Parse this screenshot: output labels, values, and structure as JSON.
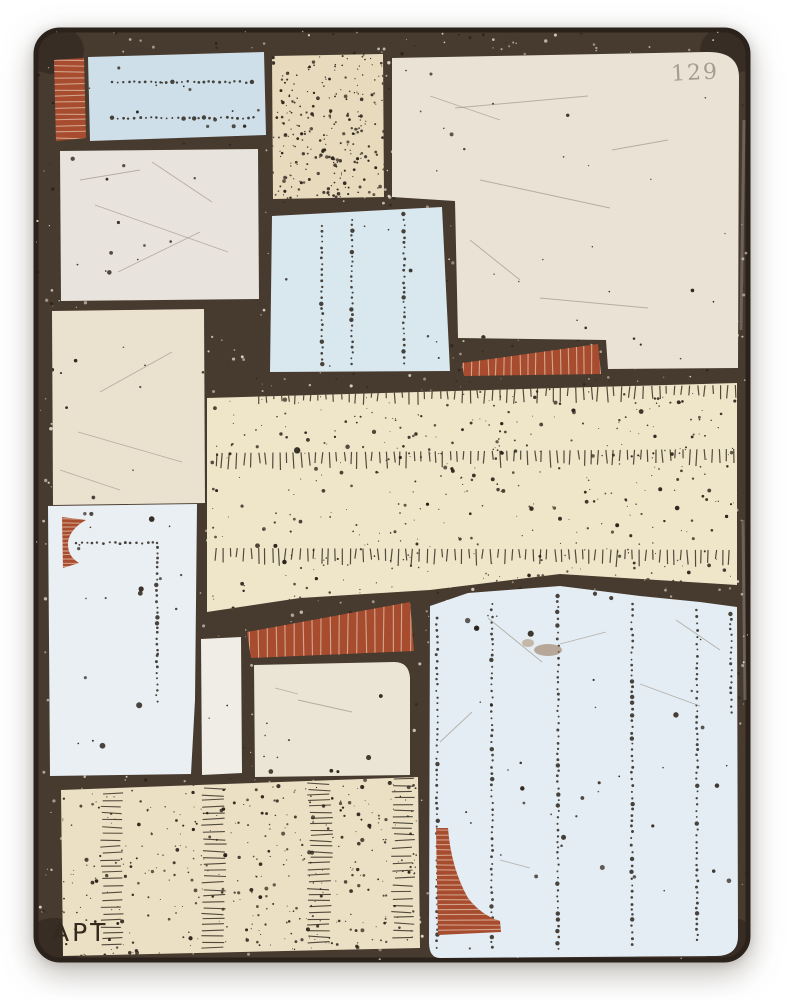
{
  "artwork": {
    "description": "Abstract mixed-media encaustic panel: patchwork of cream, tan and pale blue tiles with rust-red striped accents set in a dark speckled ground",
    "stamp": "129",
    "signature": "APT.",
    "palette": {
      "page": "#ffffff",
      "grout": "#473a2f",
      "grout_dark": "#2b221b",
      "speckle": "#e3dccd",
      "pepper": "#1f1913",
      "ink": "#2c241b",
      "red": "#a84c30",
      "red_stripe": "#ddb89f",
      "stamp_color": "#968b80",
      "sig_color": "#33291d",
      "blue_top": "#cfdfe9",
      "blue_mid": "#d9e7ef",
      "blue_left": "#eaeff3",
      "blue_big": "#e4edf4",
      "cream_big": "#eae3d5",
      "white_tl": "#e8e3dc",
      "cream_ml": "#eae1cf",
      "cream_mid": "#ebe5d5",
      "white_strip": "#f0ede7",
      "tan_top": "#e7dabd",
      "tan_band": "#efe6c9",
      "tan_bottom": "#ebe0c3",
      "scratch": "#9b9184",
      "glare": "#ffffff"
    },
    "canvas": {
      "x": 36,
      "y": 30,
      "w": 712,
      "h": 930,
      "r": 24
    },
    "corner_shadows": [
      [
        54,
        50
      ],
      [
        730,
        50
      ],
      [
        54,
        942
      ],
      [
        730,
        942
      ]
    ],
    "glare_lines": [
      [
        744,
        120,
        741,
        330
      ],
      [
        743,
        520,
        745,
        700
      ]
    ],
    "patches": [
      {
        "id": "red-bar-top-left",
        "fill": "red",
        "d": "M54,60 L84,58 L86,138 L56,141 Z",
        "box": [
          54,
          58,
          32,
          83
        ],
        "decor": [
          {
            "t": "stripesH",
            "step": 6,
            "seed": 5,
            "o": 0.8
          }
        ]
      },
      {
        "id": "blue-rect-top",
        "fill": "blue_top",
        "d": "M88,57 L264,52 L266,135 L90,141 Z",
        "box": [
          88,
          52,
          178,
          89
        ],
        "decor": [
          {
            "t": "hdots",
            "y": 82,
            "x1": 112,
            "x2": 254,
            "step": 5.5,
            "seed": 11
          },
          {
            "t": "hdots",
            "y": 118,
            "x1": 112,
            "x2": 256,
            "step": 5.5,
            "seed": 12
          },
          {
            "t": "rdots",
            "n": 14,
            "seed": 31,
            "rmin": 0.8,
            "rmax": 2.4
          }
        ]
      },
      {
        "id": "tan-dotted-top",
        "fill": "tan_top",
        "d": "M272,56 L383,54 L384,197 L273,199 Z",
        "box": [
          272,
          54,
          112,
          145
        ],
        "decor": [
          {
            "t": "rdots",
            "n": 260,
            "seed": 7,
            "rmin": 0.6,
            "rmax": 1.9
          }
        ]
      },
      {
        "id": "cream-panel-right",
        "fill": "cream_big",
        "d": "M392,58 L706,52 Q738,51 739,76 L738,368 L608,369 L606,340 L458,338 L455,201 L392,197 Z",
        "box": [
          392,
          51,
          347,
          318
        ],
        "decor": [
          {
            "t": "rdots",
            "n": 30,
            "seed": 13,
            "rmin": 0.7,
            "rmax": 2.2
          },
          {
            "t": "scratch",
            "lines": [
              [
                455,
                108,
                588,
                96
              ],
              [
                480,
                180,
                610,
                208
              ],
              [
                540,
                298,
                648,
                308
              ],
              [
                612,
                150,
                668,
                140
              ],
              [
                470,
                240,
                520,
                280
              ],
              [
                430,
                96,
                500,
                120
              ]
            ]
          }
        ]
      },
      {
        "id": "red-wedge",
        "fill": "red",
        "d": "M462,363 L598,344 L601,374 L464,376 Z",
        "box": [
          462,
          344,
          139,
          32
        ],
        "decor": [
          {
            "t": "stripesV",
            "step": 8,
            "seed": 6,
            "o": 0.85
          }
        ]
      },
      {
        "id": "white-panel-upper-left",
        "fill": "white_tl",
        "d": "M60,151 L258,149 L259,299 L61,301 Z",
        "box": [
          60,
          149,
          199,
          152
        ],
        "decor": [
          {
            "t": "rdots",
            "n": 12,
            "seed": 17,
            "rmin": 0.8,
            "rmax": 2.6
          },
          {
            "t": "scratch",
            "lines": [
              [
                95,
                205,
                228,
                252
              ],
              [
                118,
                272,
                200,
                232
              ],
              [
                152,
                162,
                212,
                202
              ],
              [
                80,
                180,
                140,
                170
              ]
            ]
          }
        ]
      },
      {
        "id": "cream-panel-mid-left",
        "fill": "cream_ml",
        "d": "M52,311 L204,309 L205,503 L53,505 Z",
        "box": [
          52,
          309,
          153,
          196
        ],
        "decor": [
          {
            "t": "rdots",
            "n": 10,
            "seed": 19,
            "rmin": 0.8,
            "rmax": 2.0
          },
          {
            "t": "scratch",
            "lines": [
              [
                78,
                432,
                182,
                462
              ],
              [
                100,
                392,
                172,
                352
              ],
              [
                60,
                470,
                120,
                490
              ]
            ]
          }
        ]
      },
      {
        "id": "blue-panel-mid",
        "fill": "blue_mid",
        "d": "M272,216 L442,207 L450,371 L270,372 Z",
        "box": [
          270,
          207,
          180,
          165
        ],
        "decor": [
          {
            "t": "vdots",
            "x": 322,
            "y1": 226,
            "y2": 366,
            "step": 5.5,
            "seed": 21
          },
          {
            "t": "vdots",
            "x": 352,
            "y1": 220,
            "y2": 368,
            "step": 5.5,
            "seed": 22
          },
          {
            "t": "vdots",
            "x": 404,
            "y1": 214,
            "y2": 368,
            "step": 5.5,
            "seed": 23
          },
          {
            "t": "rdots",
            "n": 8,
            "seed": 24,
            "rmin": 0.8,
            "rmax": 2.0
          }
        ]
      },
      {
        "id": "tan-band-wide",
        "fill": "tan_band",
        "d": "M207,398 L737,383 L737,585 L560,574 L430,590 L300,598 L207,612 Z",
        "box": [
          207,
          383,
          530,
          229
        ],
        "decor": [
          {
            "t": "dashrow",
            "x1": 258,
            "y1": 391,
            "x2": 735,
            "y2": 385,
            "step": 7.5,
            "len": 12,
            "seed": 41
          },
          {
            "t": "dashrow",
            "x1": 216,
            "y1": 453,
            "x2": 733,
            "y2": 449,
            "step": 7,
            "len": 13,
            "seed": 43
          },
          {
            "t": "dashrow",
            "x1": 216,
            "y1": 548,
            "x2": 730,
            "y2": 550,
            "step": 7,
            "len": 13,
            "seed": 47
          },
          {
            "t": "rdots",
            "n": 460,
            "seed": 3,
            "rmin": 0.5,
            "rmax": 2.0
          },
          {
            "t": "rdots",
            "n": 14,
            "seed": 51,
            "rmin": 2.0,
            "rmax": 3.4
          }
        ]
      },
      {
        "id": "blue-panel-left",
        "fill": "blue_left",
        "d": "M48,506 L197,504 L195,700 L191,774 L50,776 Z",
        "box": [
          48,
          504,
          149,
          272
        ],
        "decor": [
          {
            "t": "hdots",
            "y": 543,
            "x1": 76,
            "x2": 156,
            "step": 5.5,
            "seed": 25
          },
          {
            "t": "vdots",
            "x": 157,
            "y1": 543,
            "y2": 703,
            "step": 5.5,
            "seed": 26
          },
          {
            "t": "rdots",
            "n": 20,
            "seed": 29,
            "rmin": 0.8,
            "rmax": 3.2
          }
        ]
      },
      {
        "id": "red-notch",
        "fill": "red",
        "d": "M62,517 L86,520 Q70,529 68,542 Q67,556 79,563 L63,568 Z",
        "box": [
          62,
          517,
          24,
          51
        ],
        "decor": [
          {
            "t": "stripesH",
            "step": 4,
            "seed": 8,
            "o": 0.8
          }
        ]
      },
      {
        "id": "white-strip",
        "fill": "white_strip",
        "d": "M201,639 L241,637 L242,773 L202,775 Z",
        "box": [
          201,
          637,
          41,
          138
        ],
        "decor": [
          {
            "t": "rdots",
            "n": 3,
            "seed": 37,
            "rmin": 0.6,
            "rmax": 1.5
          }
        ]
      },
      {
        "id": "red-bar-mid",
        "fill": "red",
        "d": "M247,632 L410,602 L414,651 L251,658 Z",
        "box": [
          247,
          602,
          167,
          56
        ],
        "decor": [
          {
            "t": "stripesV",
            "step": 9,
            "seed": 9,
            "o": 0.85
          }
        ]
      },
      {
        "id": "cream-panel-mid",
        "fill": "cream_mid",
        "d": "M254,665 L394,662 Q409,662 410,678 L410,775 L255,777 Z",
        "box": [
          254,
          662,
          156,
          115
        ],
        "decor": [
          {
            "t": "rdots",
            "n": 10,
            "seed": 53,
            "rmin": 0.8,
            "rmax": 2.6
          },
          {
            "t": "scratch",
            "lines": [
              [
                298,
                700,
                352,
                712
              ],
              [
                275,
                688,
                298,
                694
              ]
            ]
          }
        ]
      },
      {
        "id": "blue-panel-large",
        "fill": "blue_big",
        "d": "M430,606 L468,593 L560,586 L640,596 L700,602 L737,607 L738,936 Q738,956 716,956 L440,958 Q429,958 429,942 Z",
        "box": [
          429,
          586,
          309,
          372
        ],
        "decor": [
          {
            "t": "vdots",
            "x": 437,
            "y1": 618,
            "y2": 948,
            "step": 6,
            "seed": 61
          },
          {
            "t": "vdots",
            "x": 492,
            "y1": 604,
            "y2": 950,
            "step": 6,
            "seed": 62
          },
          {
            "t": "vdots",
            "x": 558,
            "y1": 596,
            "y2": 952,
            "step": 6,
            "seed": 63
          },
          {
            "t": "vdots",
            "x": 632,
            "y1": 604,
            "y2": 948,
            "step": 6,
            "seed": 64
          },
          {
            "t": "vdots",
            "x": 697,
            "y1": 610,
            "y2": 946,
            "step": 6,
            "seed": 65
          },
          {
            "t": "vdots",
            "x": 731,
            "y1": 614,
            "y2": 716,
            "step": 6,
            "seed": 66
          },
          {
            "t": "rdots",
            "n": 42,
            "seed": 59,
            "rmin": 0.8,
            "rmax": 3.3
          },
          {
            "t": "blob",
            "x": 548,
            "y": 650,
            "rx": 14,
            "ry": 6,
            "color": "#8f6d4c",
            "o": 0.55
          },
          {
            "t": "blob",
            "x": 528,
            "y": 643,
            "rx": 6,
            "ry": 4,
            "color": "#a5825c",
            "o": 0.5
          },
          {
            "t": "scratch",
            "lines": [
              [
                488,
                618,
                542,
                662
              ],
              [
                560,
                644,
                606,
                632
              ],
              [
                640,
                684,
                700,
                706
              ],
              [
                472,
                712,
                440,
                742
              ],
              [
                676,
                620,
                720,
                650
              ],
              [
                500,
                860,
                530,
                868
              ]
            ]
          }
        ]
      },
      {
        "id": "red-curved-triangle",
        "fill": "red",
        "d": "M436,828 L448,828 Q451,868 468,898 Q481,915 500,921 L501,932 L438,935 Z",
        "box": [
          436,
          828,
          66,
          107
        ],
        "decor": [
          {
            "t": "stripesH",
            "step": 5,
            "seed": 10,
            "o": 0.8
          }
        ]
      },
      {
        "id": "tan-panel-bottom",
        "fill": "tan_bottom",
        "d": "M61,790 L418,777 L420,948 L63,956 Z",
        "box": [
          61,
          777,
          359,
          179
        ],
        "decor": [
          {
            "t": "rdots",
            "n": 420,
            "seed": 67,
            "rmin": 0.5,
            "rmax": 2.1
          },
          {
            "t": "ladder",
            "x": 112,
            "y1": 794,
            "y2": 948,
            "step": 6.5,
            "len": 20,
            "seed": 71
          },
          {
            "t": "ladder",
            "x": 214,
            "y1": 788,
            "y2": 950,
            "step": 6,
            "len": 22,
            "seed": 73
          },
          {
            "t": "ladder",
            "x": 320,
            "y1": 783,
            "y2": 948,
            "step": 6,
            "len": 22,
            "seed": 79
          },
          {
            "t": "ladder",
            "x": 403,
            "y1": 779,
            "y2": 944,
            "step": 6.5,
            "len": 20,
            "seed": 83
          }
        ]
      }
    ]
  }
}
